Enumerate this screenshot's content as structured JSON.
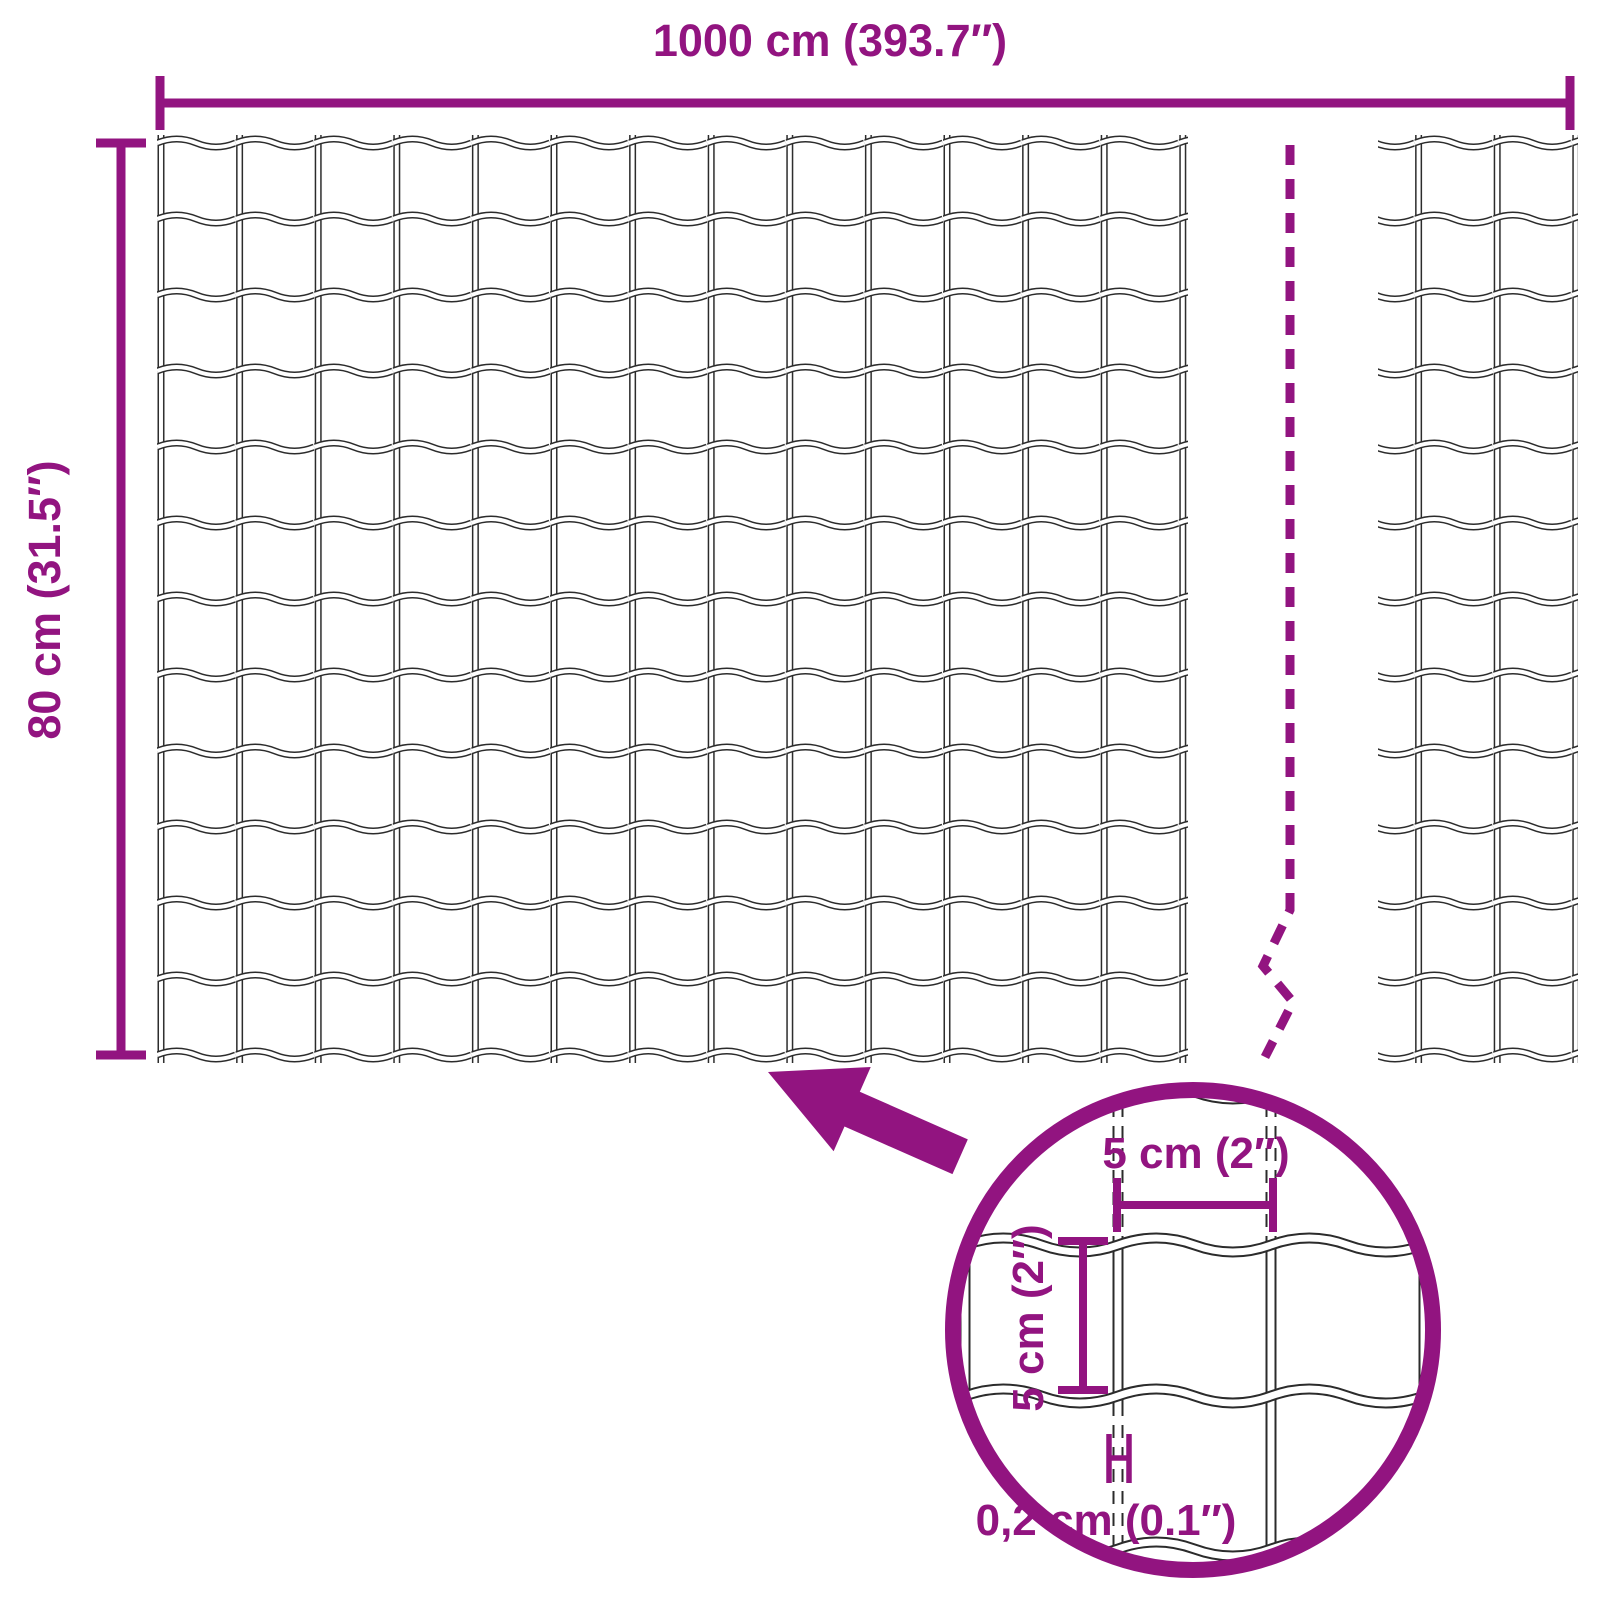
{
  "colors": {
    "accent": "#921480",
    "wire": "#2b2b2b"
  },
  "dimensions": {
    "width_label": "1000 cm (393.7″)",
    "height_label": "80 cm (31.5″)"
  },
  "detail_view": {
    "cell_width_label": "5 cm (2″)",
    "cell_height_label": "5 cm (2″)",
    "wire_thickness_label": "0,2 cm (0.1″)"
  }
}
